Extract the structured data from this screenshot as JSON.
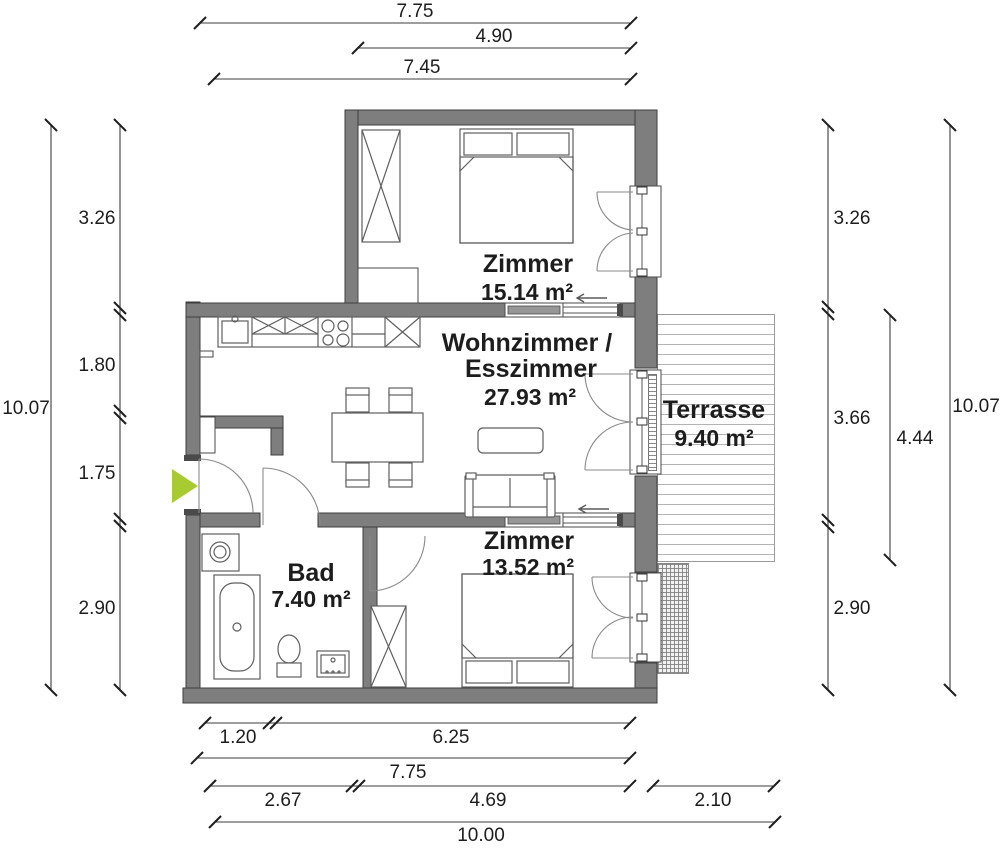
{
  "title": "Wohnungsgrundriss",
  "colors": {
    "wall": "#7e7e7e",
    "entry_arrow": "#a9cb32"
  },
  "rooms": {
    "zimmer1": {
      "name": "Zimmer",
      "area": "15.14 m²"
    },
    "wohnzimmer": {
      "name_line1": "Wohnzimmer /",
      "name_line2": "Esszimmer",
      "area": "27.93 m²"
    },
    "terrasse": {
      "name": "Terrasse",
      "area": "9.40 m²"
    },
    "bad": {
      "name": "Bad",
      "area": "7.40 m²"
    },
    "zimmer2": {
      "name": "Zimmer",
      "area": "13.52 m²"
    }
  },
  "dimensions": {
    "top": [
      "7.75",
      "4.90",
      "7.45"
    ],
    "bottom": {
      "row1": [
        "1.20",
        "6.25"
      ],
      "row2": [
        "7.75"
      ],
      "row3": [
        "2.67",
        "4.69",
        "2.10"
      ],
      "row4": [
        "10.00"
      ]
    },
    "left": {
      "total": "10.07",
      "segments": [
        "3.26",
        "1.80",
        "1.75",
        "2.90"
      ]
    },
    "right": {
      "segments": [
        "3.26",
        "3.66",
        "2.90"
      ],
      "terrace_depth": "4.44",
      "total": "10.07"
    }
  }
}
